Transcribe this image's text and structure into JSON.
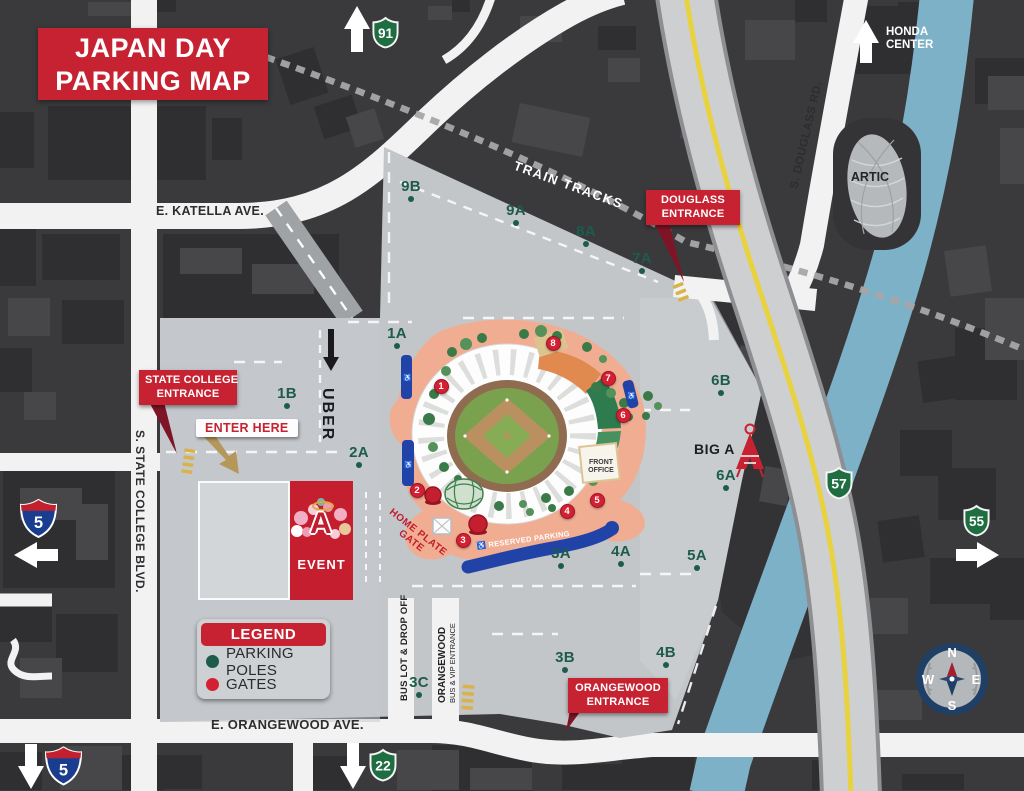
{
  "title": {
    "line1": "JAPAN DAY",
    "line2": "PARKING MAP"
  },
  "legend": {
    "header": "LEGEND",
    "items": [
      {
        "label": "PARKING POLES",
        "color": "#1d5c4a"
      },
      {
        "label": "GATES",
        "color": "#d32032"
      }
    ]
  },
  "road_labels": {
    "katella": "E. KATELLA AVE.",
    "orangewood": "E. ORANGEWOOD AVE.",
    "state_college": "S. STATE COLLEGE BLVD.",
    "douglass": "S. DOUGLASS RD.",
    "train_tracks": "TRAIN TRACKS",
    "uber": "UBER",
    "bus_lot": "BUS LOT & DROP OFF",
    "vip_line1": "ORANGEWOOD",
    "vip_line2": "BUS & VIP ENTRANCE"
  },
  "badges": {
    "state_college_l1": "STATE COLLEGE",
    "state_college_l2": "ENTRANCE",
    "douglass_l1": "DOUGLASS",
    "douglass_l2": "ENTRANCE",
    "orangewood_l1": "ORANGEWOOD",
    "orangewood_l2": "ENTRANCE",
    "enter_here": "ENTER HERE",
    "parking": "PARKING",
    "event": "EVENT"
  },
  "landmarks": {
    "honda_l1": "HONDA",
    "honda_l2": "CENTER",
    "artic": "ARTIC",
    "big_a": "BIG A",
    "front_office_l1": "FRONT",
    "front_office_l2": "OFFICE",
    "home_plate_l1": "HOME PLATE",
    "home_plate_l2": "GATE",
    "reserved": "RESERVED PARKING"
  },
  "shields": {
    "i5": "5",
    "r91": "91",
    "r57": "57",
    "r55": "55",
    "r22": "22"
  },
  "icons": {
    "wheelchair": "♿",
    "angels_a": "A"
  },
  "colors": {
    "accent_red": "#c62231",
    "pole_green": "#1d5c4a",
    "gate_red": "#d32032",
    "shield_green": "#1e6e41",
    "reserved_blue": "#2143a8",
    "river_blue": "#7cb1c7",
    "freeway_yellow": "#e8d23f"
  },
  "parking_poles": [
    {
      "id": "9B",
      "x": 411,
      "y": 190
    },
    {
      "id": "9A",
      "x": 516,
      "y": 214
    },
    {
      "id": "8A",
      "x": 586,
      "y": 235
    },
    {
      "id": "7A",
      "x": 642,
      "y": 262
    },
    {
      "id": "1A",
      "x": 397,
      "y": 337
    },
    {
      "id": "1B",
      "x": 287,
      "y": 397
    },
    {
      "id": "2A",
      "x": 359,
      "y": 456
    },
    {
      "id": "6B",
      "x": 721,
      "y": 384
    },
    {
      "id": "6A",
      "x": 726,
      "y": 479
    },
    {
      "id": "5A",
      "x": 697,
      "y": 559
    },
    {
      "id": "3A",
      "x": 561,
      "y": 557
    },
    {
      "id": "4A",
      "x": 621,
      "y": 555
    },
    {
      "id": "3B",
      "x": 565,
      "y": 661
    },
    {
      "id": "4B",
      "x": 666,
      "y": 656
    },
    {
      "id": "3C",
      "x": 419,
      "y": 686
    }
  ],
  "gates": [
    {
      "num": "1",
      "x": 441,
      "y": 386
    },
    {
      "num": "2",
      "x": 417,
      "y": 490
    },
    {
      "num": "3",
      "x": 463,
      "y": 540
    },
    {
      "num": "4",
      "x": 567,
      "y": 511
    },
    {
      "num": "5",
      "x": 597,
      "y": 500
    },
    {
      "num": "6",
      "x": 623,
      "y": 415
    },
    {
      "num": "7",
      "x": 608,
      "y": 378
    },
    {
      "num": "8",
      "x": 553,
      "y": 343
    }
  ],
  "compass": {
    "n": "N",
    "e": "E",
    "s": "S",
    "w": "W"
  }
}
